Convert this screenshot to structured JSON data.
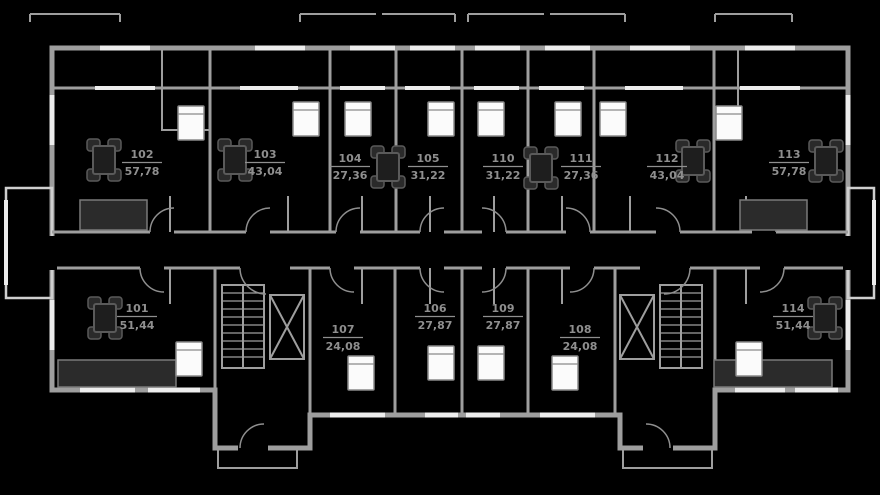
{
  "theme": {
    "background": "#000000",
    "wall": "#9e9e9e",
    "wall_light": "#cfcfcf",
    "window": "#ededed",
    "furniture": "#5a5a5a",
    "bed_fill": "#fbfbfb",
    "label": "#8f8f8f"
  },
  "apartments": [
    {
      "number": "101",
      "area": "51,44"
    },
    {
      "number": "102",
      "area": "57,78"
    },
    {
      "number": "103",
      "area": "43,04"
    },
    {
      "number": "104",
      "area": "27,36"
    },
    {
      "number": "105",
      "area": "31,22"
    },
    {
      "number": "106",
      "area": "27,87"
    },
    {
      "number": "107",
      "area": "24,08"
    },
    {
      "number": "108",
      "area": "24,08"
    },
    {
      "number": "109",
      "area": "27,87"
    },
    {
      "number": "110",
      "area": "31,22"
    },
    {
      "number": "111",
      "area": "27,36"
    },
    {
      "number": "112",
      "area": "43,04"
    },
    {
      "number": "113",
      "area": "57,78"
    },
    {
      "number": "114",
      "area": "51,44"
    }
  ]
}
